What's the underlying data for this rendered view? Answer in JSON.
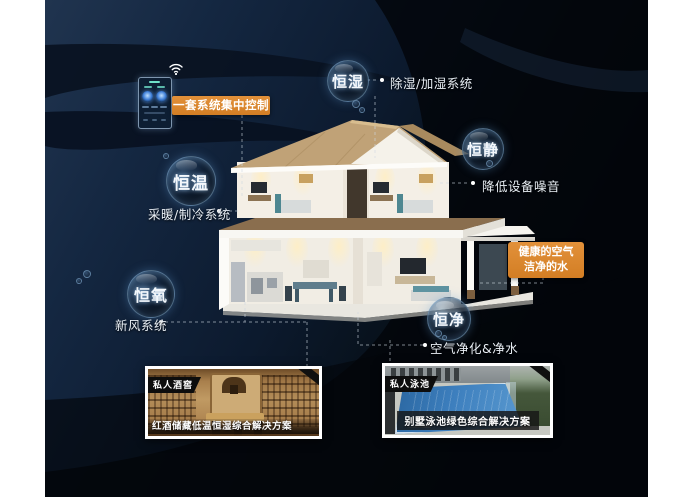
{
  "scene": {
    "description": "smart-home five-constants infographic",
    "colors": {
      "accent_orange": "#de862b",
      "background_navy": "#0c1a2e",
      "bubble_rim_blue": "#8cb9e1",
      "text_light": "#e9eff5"
    }
  },
  "control": {
    "label": "一套系统集中控制",
    "device": "wall-mounted smart control panel",
    "wifi_icon": "wifi-icon"
  },
  "features": [
    {
      "id": "constant-humidity",
      "label": "恒湿",
      "note": "除湿/加湿系统"
    },
    {
      "id": "constant-quiet",
      "label": "恒静",
      "note": "降低设备噪音"
    },
    {
      "id": "constant-temperature",
      "label": "恒温",
      "note": "采暖/制冷系统"
    },
    {
      "id": "constant-oxygen",
      "label": "恒氧",
      "note": "新风系统"
    },
    {
      "id": "constant-purity",
      "label": "恒净",
      "note": "空气净化&净水"
    }
  ],
  "highlight": {
    "line1": "健康的空气",
    "line2": "洁净的水"
  },
  "photos": [
    {
      "tag": "私人酒窖",
      "caption": "红酒储藏低温恒湿综合解决方案"
    },
    {
      "tag": "私人泳池",
      "caption": "别墅泳池绿色综合解决方案"
    }
  ]
}
